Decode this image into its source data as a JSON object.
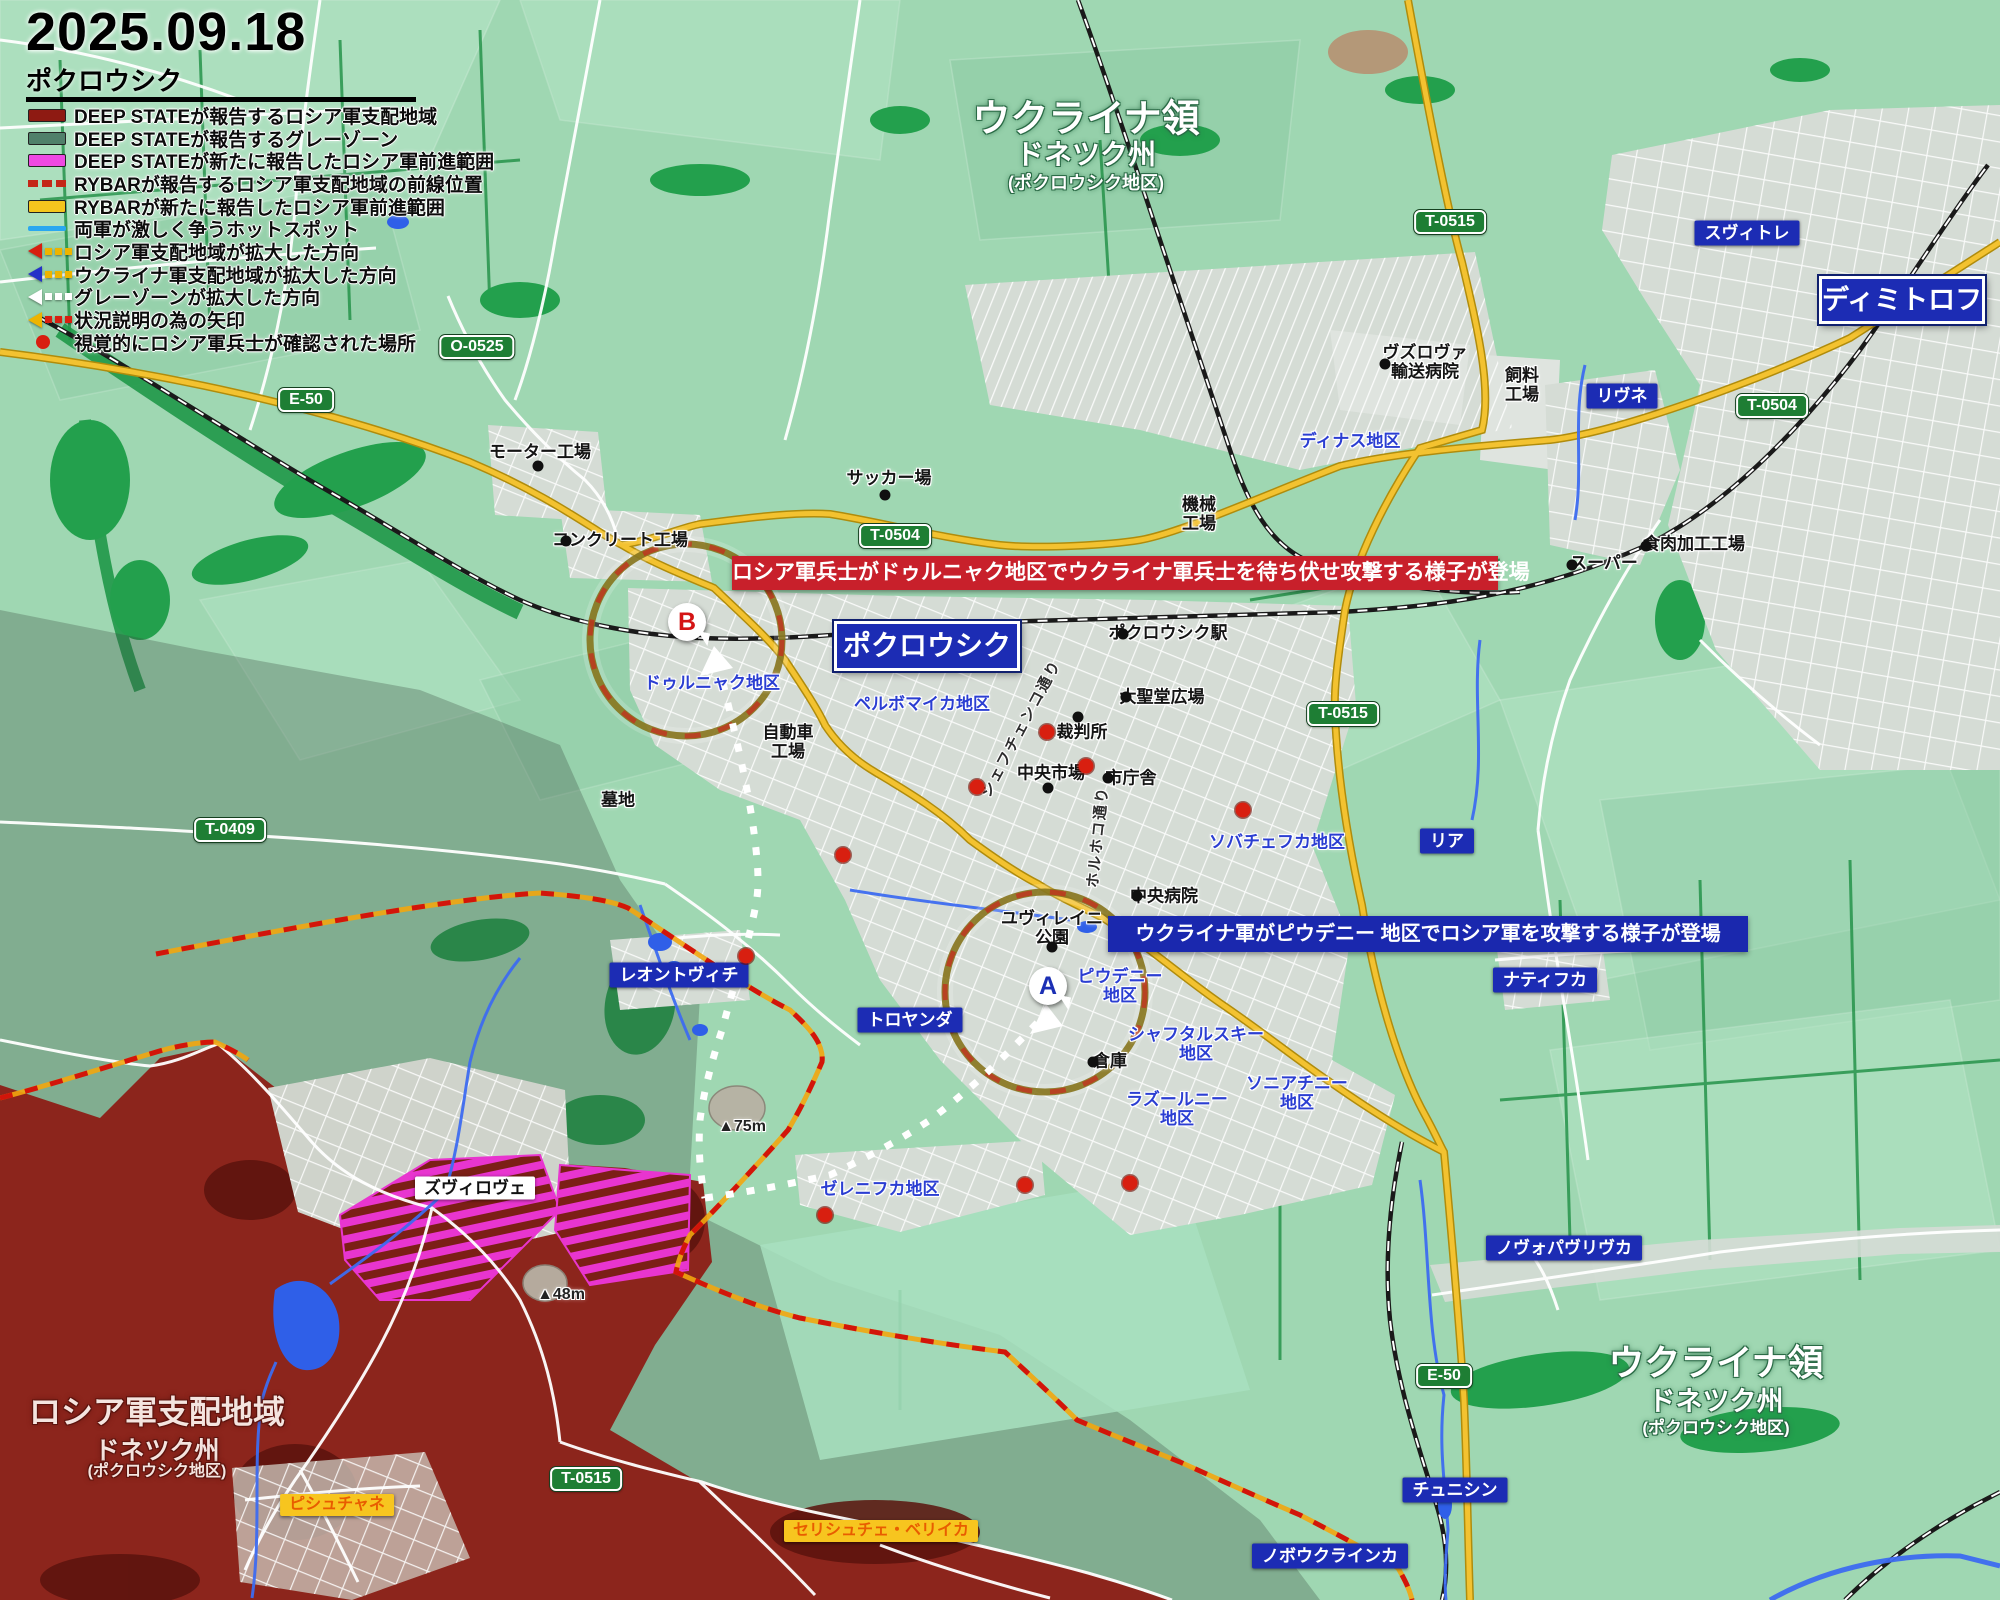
{
  "header": {
    "date": "2025.09.18",
    "place": "ポクロウシク"
  },
  "legend": [
    {
      "icon": "swatch",
      "color": "#8e1a12",
      "label": "DEEP STATEが報告するロシア軍支配地域"
    },
    {
      "icon": "swatch",
      "color": "#50806a",
      "label": "DEEP STATEが報告するグレーゾーン"
    },
    {
      "icon": "swatch",
      "color": "#ee49e2",
      "label": "DEEP STATEが新たに報告したロシア軍前進範囲"
    },
    {
      "icon": "dash",
      "color": "#c42718",
      "label": "RYBARが報告するロシア軍支配地域の前線位置"
    },
    {
      "icon": "swatch",
      "color": "#f5c51e",
      "label": "RYBARが新たに報告したロシア軍前進範囲"
    },
    {
      "icon": "line",
      "color": "#2aa7f0",
      "label": "両軍が激しく争うホットスポット"
    },
    {
      "icon": "arrow",
      "color": "#d81f10",
      "dots": "#edb400",
      "label": "ロシア軍支配地域が拡大した方向"
    },
    {
      "icon": "arrow",
      "color": "#2431c8",
      "dots": "#edb400",
      "label": "ウクライナ軍支配地域が拡大した方向"
    },
    {
      "icon": "arrow",
      "color": "#ffffff",
      "dots": "#ffffff",
      "label": "グレーゾーンが拡大した方向"
    },
    {
      "icon": "arrow",
      "color": "#edb400",
      "dots": "#d81f10",
      "label": "状況説明の為の矢印"
    },
    {
      "icon": "dot",
      "color": "#d81f10",
      "label": "視覚的にロシア軍兵士が確認された場所"
    }
  ],
  "banners": {
    "red": "ロシア軍兵士がドゥルニャク地区でウクライナ軍兵士を待ち伏せ攻撃する様子が登場",
    "blue": "ウクライナ軍がピウデニー 地区でロシア軍を攻撃する様子が登場"
  },
  "territories": {
    "top": {
      "l1": "ウクライナ領",
      "l2": "ドネツク州",
      "l3": "(ポクロウシク地区)"
    },
    "bottom_right": {
      "l1": "ウクライナ領",
      "l2": "ドネツク州",
      "l3": "(ポクロウシク地区)"
    },
    "russian": {
      "l1": "ロシア軍支配地域",
      "l2": "ドネツク州",
      "l3": "(ポクロウシク地区)"
    }
  },
  "city_boxes": [
    {
      "text": "ポクロウシク",
      "x": 927,
      "y": 646
    },
    {
      "text": "ディミトロフ",
      "x": 1902,
      "y": 300
    }
  ],
  "road_shields": [
    {
      "text": "E-50",
      "x": 306,
      "y": 400
    },
    {
      "text": "O-0525",
      "x": 477,
      "y": 347
    },
    {
      "text": "T-0504",
      "x": 895,
      "y": 536
    },
    {
      "text": "T-0515",
      "x": 1450,
      "y": 222
    },
    {
      "text": "T-0504",
      "x": 1772,
      "y": 406
    },
    {
      "text": "T-0515",
      "x": 1343,
      "y": 714
    },
    {
      "text": "T-0409",
      "x": 230,
      "y": 830
    },
    {
      "text": "T-0515",
      "x": 586,
      "y": 1479
    },
    {
      "text": "E-50",
      "x": 1444,
      "y": 1376
    }
  ],
  "town_labels": [
    {
      "text": "スヴィトレ",
      "x": 1747,
      "y": 233
    },
    {
      "text": "リヴネ",
      "x": 1622,
      "y": 396
    },
    {
      "text": "リア",
      "x": 1447,
      "y": 841
    },
    {
      "text": "ナティフカ",
      "x": 1545,
      "y": 980
    },
    {
      "text": "トロヤンダ",
      "x": 910,
      "y": 1020
    },
    {
      "text": "レオントヴィチ",
      "x": 679,
      "y": 975
    },
    {
      "text": "ノヴォパヴリヴカ",
      "x": 1564,
      "y": 1248
    },
    {
      "text": "チュニシン",
      "x": 1455,
      "y": 1490
    },
    {
      "text": "ノボウクラインカ",
      "x": 1330,
      "y": 1556
    }
  ],
  "white_labels": [
    {
      "text": "ズヴィロヴェ",
      "x": 475,
      "y": 1188
    }
  ],
  "yellow_labels": [
    {
      "text": "ピシュチャネ",
      "x": 337,
      "y": 1505
    },
    {
      "text": "セリシュチェ・ベリイカ",
      "x": 881,
      "y": 1531
    }
  ],
  "district_labels": [
    {
      "text": "ディナス地区",
      "x": 1350,
      "y": 441
    },
    {
      "text": "ドゥルニャク地区",
      "x": 712,
      "y": 683
    },
    {
      "text": "ペルボマイカ地区",
      "x": 922,
      "y": 704
    },
    {
      "text": "ソバチェフカ地区",
      "x": 1277,
      "y": 842
    },
    {
      "text": "ピウデニー\n地区",
      "x": 1120,
      "y": 986
    },
    {
      "text": "シャフタルスキー\n地区",
      "x": 1196,
      "y": 1044
    },
    {
      "text": "ラズールニー\n地区",
      "x": 1177,
      "y": 1109
    },
    {
      "text": "ソニアチニー\n地区",
      "x": 1297,
      "y": 1093
    },
    {
      "text": "ゼレニフカ地区",
      "x": 880,
      "y": 1189
    }
  ],
  "poi_labels": [
    {
      "text": "ヴズロヴァ\n輸送病院",
      "x": 1425,
      "y": 362
    },
    {
      "text": "飼料\n工場",
      "x": 1522,
      "y": 385
    },
    {
      "text": "機械\n工場",
      "x": 1199,
      "y": 514
    },
    {
      "text": "スーパー",
      "x": 1604,
      "y": 563
    },
    {
      "text": "食肉加工工場",
      "x": 1694,
      "y": 544
    },
    {
      "text": "モーター工場",
      "x": 540,
      "y": 452
    },
    {
      "text": "コンクリート工場",
      "x": 620,
      "y": 540
    },
    {
      "text": "サッカー場",
      "x": 889,
      "y": 478
    },
    {
      "text": "ポクロウシク駅",
      "x": 1168,
      "y": 633
    },
    {
      "text": "大聖堂広場",
      "x": 1162,
      "y": 697
    },
    {
      "text": "裁判所",
      "x": 1082,
      "y": 732
    },
    {
      "text": "中央市場",
      "x": 1051,
      "y": 773
    },
    {
      "text": "市庁舎",
      "x": 1131,
      "y": 778
    },
    {
      "text": "中央病院",
      "x": 1164,
      "y": 896
    },
    {
      "text": "ユヴィレイニ\n公園",
      "x": 1052,
      "y": 928
    },
    {
      "text": "倉庫",
      "x": 1110,
      "y": 1061
    },
    {
      "text": "自動車\n工場",
      "x": 788,
      "y": 742
    },
    {
      "text": "墓地",
      "x": 618,
      "y": 800
    }
  ],
  "street_labels": [
    {
      "text": "シェフチェンコ通り",
      "x": 1022,
      "y": 729,
      "rot": -62
    },
    {
      "text": "ホルホコ通り",
      "x": 1099,
      "y": 837,
      "rot": -84
    }
  ],
  "elevation_labels": [
    {
      "text": "▲75m",
      "x": 742,
      "y": 1127
    },
    {
      "text": "▲48m",
      "x": 561,
      "y": 1295
    }
  ],
  "markers": [
    {
      "letter": "B",
      "color": "#d41414",
      "x": 687,
      "y": 622
    },
    {
      "letter": "A",
      "color": "#1b2fb4",
      "x": 1048,
      "y": 986
    }
  ],
  "red_dots": [
    {
      "x": 1047,
      "y": 732
    },
    {
      "x": 1086,
      "y": 766
    },
    {
      "x": 977,
      "y": 787
    },
    {
      "x": 843,
      "y": 855
    },
    {
      "x": 1243,
      "y": 810
    },
    {
      "x": 746,
      "y": 956
    },
    {
      "x": 825,
      "y": 1215
    },
    {
      "x": 1025,
      "y": 1185
    },
    {
      "x": 1130,
      "y": 1183
    }
  ],
  "black_dots": [
    {
      "x": 1385,
      "y": 364
    },
    {
      "x": 538,
      "y": 466
    },
    {
      "x": 566,
      "y": 541
    },
    {
      "x": 885,
      "y": 495
    },
    {
      "x": 1123,
      "y": 634
    },
    {
      "x": 1126,
      "y": 697
    },
    {
      "x": 1078,
      "y": 717
    },
    {
      "x": 1048,
      "y": 788
    },
    {
      "x": 1108,
      "y": 778
    },
    {
      "x": 1137,
      "y": 896
    },
    {
      "x": 1052,
      "y": 947
    },
    {
      "x": 1093,
      "y": 1062
    },
    {
      "x": 1572,
      "y": 565
    },
    {
      "x": 1646,
      "y": 546
    }
  ],
  "colors": {
    "base_green": "#9fd7b2",
    "forest": "#23a04d",
    "russian_red": "#8c251c",
    "magenta": "#e835cf",
    "road_yellow": "#f3c230",
    "river_blue": "#3d6cf0",
    "label_blue": "#1c2cb4",
    "banner_red": "#c8202b",
    "banner_blue": "#1a28ae",
    "shield_green": "#1e7e34"
  }
}
